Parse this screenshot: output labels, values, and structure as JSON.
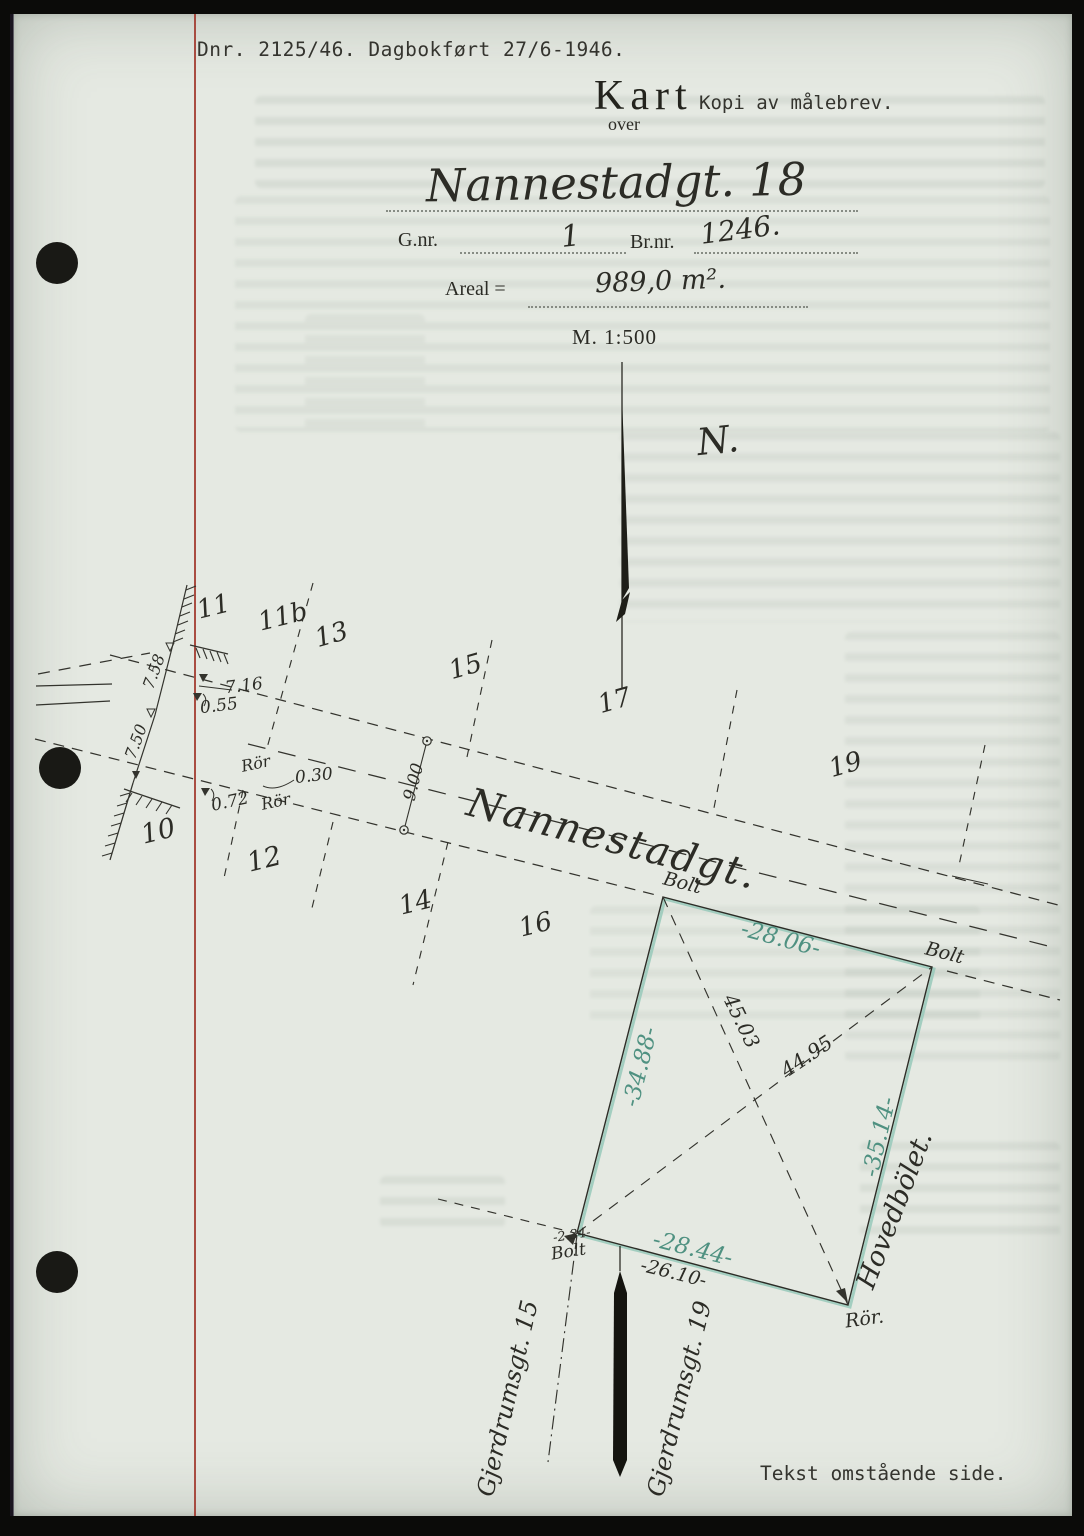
{
  "document": {
    "header": {
      "dnr_line": "Dnr. 2125/46. Dagbokført 27/6-1946.",
      "title": "Kart",
      "subtitle": "Kopi av målebrev.",
      "over": "over"
    },
    "form": {
      "street_value": "Nannestadgt. 18",
      "gnr_label": "G.nr.",
      "gnr_value": "1",
      "brnr_label": "Br.nr.",
      "brnr_value": "1246.",
      "areal_label": "Areal =",
      "areal_value": "989,0 m².",
      "scale": "M. 1:500"
    },
    "footer_note": "Tekst omstående side."
  },
  "map": {
    "north_label": "N.",
    "street_name": "Nannestadgt.",
    "cross_streets": {
      "gjerdrumsgt_15": "Gjerdrumsgt. 15",
      "gjerdrumsgt_19": "Gjerdrumsgt. 19"
    },
    "parcel_name": "Hovedbölet.",
    "lot_numbers": {
      "n10": "10",
      "n11": "11",
      "n11b": "11b",
      "n12": "12",
      "n13": "13",
      "n14": "14",
      "n15": "15",
      "n16": "16",
      "n17": "17",
      "n19": "19"
    },
    "edge_measurements": {
      "top": "-28.06-",
      "left": "-34.88-",
      "right": "-35.14-",
      "bottom": "-28.44-",
      "bottom_street": "-26.10-"
    },
    "diagonal_measurements": {
      "d1": "45.03",
      "d2": "44.95"
    },
    "offset_measurements": {
      "m758": "7.58",
      "m716": "7.16",
      "m055": "0.55",
      "m750": "7.50",
      "m030": "0.30",
      "m072": "0.72",
      "m900": "9.00",
      "m234": "-2.34-"
    },
    "markers": {
      "bolt_top_left": "Bolt",
      "bolt_top_right": "Bolt",
      "bolt_bottom_left": "Bolt",
      "ror_bottom_right": "Rör.",
      "ror_west_1": "Rör",
      "ror_west_2": "Rör"
    }
  },
  "colors": {
    "paper": "#e5e9e2",
    "ink": "#33332d",
    "teal_text": "#4f9181",
    "teal_line": "#98cabb",
    "margin_red": "#a23c31"
  }
}
